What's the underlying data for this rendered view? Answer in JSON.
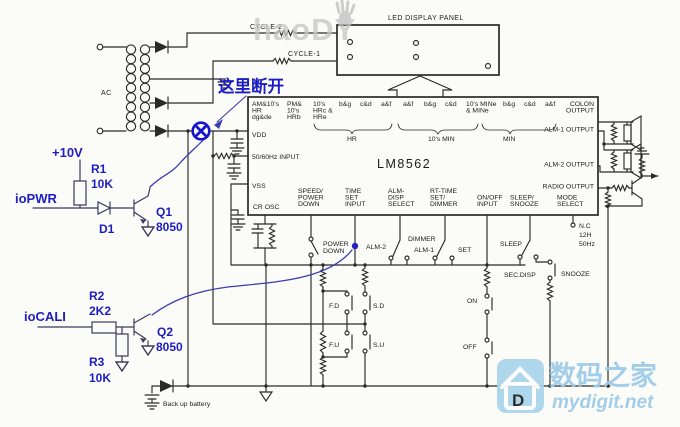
{
  "watermarks": {
    "top": "haoDY",
    "site_name": "数码之家",
    "site_url": "mydigit.net",
    "logo_letter": "D"
  },
  "annotation": {
    "break_note": "这里断开"
  },
  "mod": {
    "supply": "+10V",
    "r1": "R1",
    "r1_value": "10K",
    "io_pwr": "ioPWR",
    "d1": "D1",
    "q1": "Q1",
    "q1_model": "8050",
    "io_cali": "ioCALI",
    "r2": "R2",
    "r2_value": "2K2",
    "r3": "R3",
    "r3_value": "10K",
    "q2": "Q2",
    "q2_model": "8050"
  },
  "transformer": {
    "label": "AC"
  },
  "rails": {
    "cycle2": "CYCLE-2",
    "cycle1": "CYCLE-1"
  },
  "display": {
    "title": "LED DISPLAY PANEL",
    "digits": [
      "d",
      "8",
      "8",
      "8"
    ]
  },
  "ic": {
    "name": "LM8562",
    "top_pins": [
      [
        "AM&10's",
        "HR",
        "dg&de"
      ],
      [
        "PM&",
        "10's",
        "HRb"
      ],
      [
        "10's",
        "HRc &",
        "HRe"
      ],
      [
        "b&g"
      ],
      [
        "c&d"
      ],
      [
        "a&f"
      ],
      [
        "a&f"
      ],
      [
        "b&g"
      ],
      [
        "c&d"
      ],
      [
        "10's MINe",
        "& MINe"
      ],
      [
        "b&g"
      ],
      [
        "c&d"
      ],
      [
        "a&f"
      ]
    ],
    "top_groups": [
      "HR",
      "10's MIN",
      "MIN"
    ],
    "left_pins": [
      "VDD",
      "50/60Hz INPUT",
      "VSS"
    ],
    "right_pins": [
      [
        "COLON",
        "OUTPUT"
      ],
      [
        "ALM-1 OUTPUT"
      ],
      [
        "ALM-2 OUTPUT"
      ],
      [
        "RADIO OUTPUT"
      ]
    ],
    "bottom_pins": [
      [
        "CR OSC"
      ],
      [
        "SPEED/",
        "POWER",
        "DOWN"
      ],
      [
        "TIME",
        "SET",
        "INPUT"
      ],
      [
        "ALM-",
        "DISP",
        "SELECT"
      ],
      [
        "RT-TIME",
        "SET/",
        "DIMMER"
      ],
      [
        "ON/OFF",
        "INPUT"
      ],
      [
        "SLEEP/",
        "SNOOZE"
      ],
      [
        "MODE",
        "SELECT"
      ]
    ],
    "mode_options": [
      "N.C",
      "12H",
      "50Hz"
    ]
  },
  "controls": {
    "power_down": [
      "POWER",
      "DOWN"
    ],
    "alm2": "ALM-2",
    "dimmer": "DIMMER",
    "alm1": "ALM-1",
    "set": "SET",
    "sleep": "SLEEP",
    "sec_disp": "SEC.DISP",
    "snooze": "SNOOZE",
    "fd": "F.D",
    "sd": "S.D",
    "fu": "F.U",
    "su": "S.U",
    "on": "ON",
    "off": "OFF"
  },
  "battery": {
    "label": "Back up battery"
  }
}
